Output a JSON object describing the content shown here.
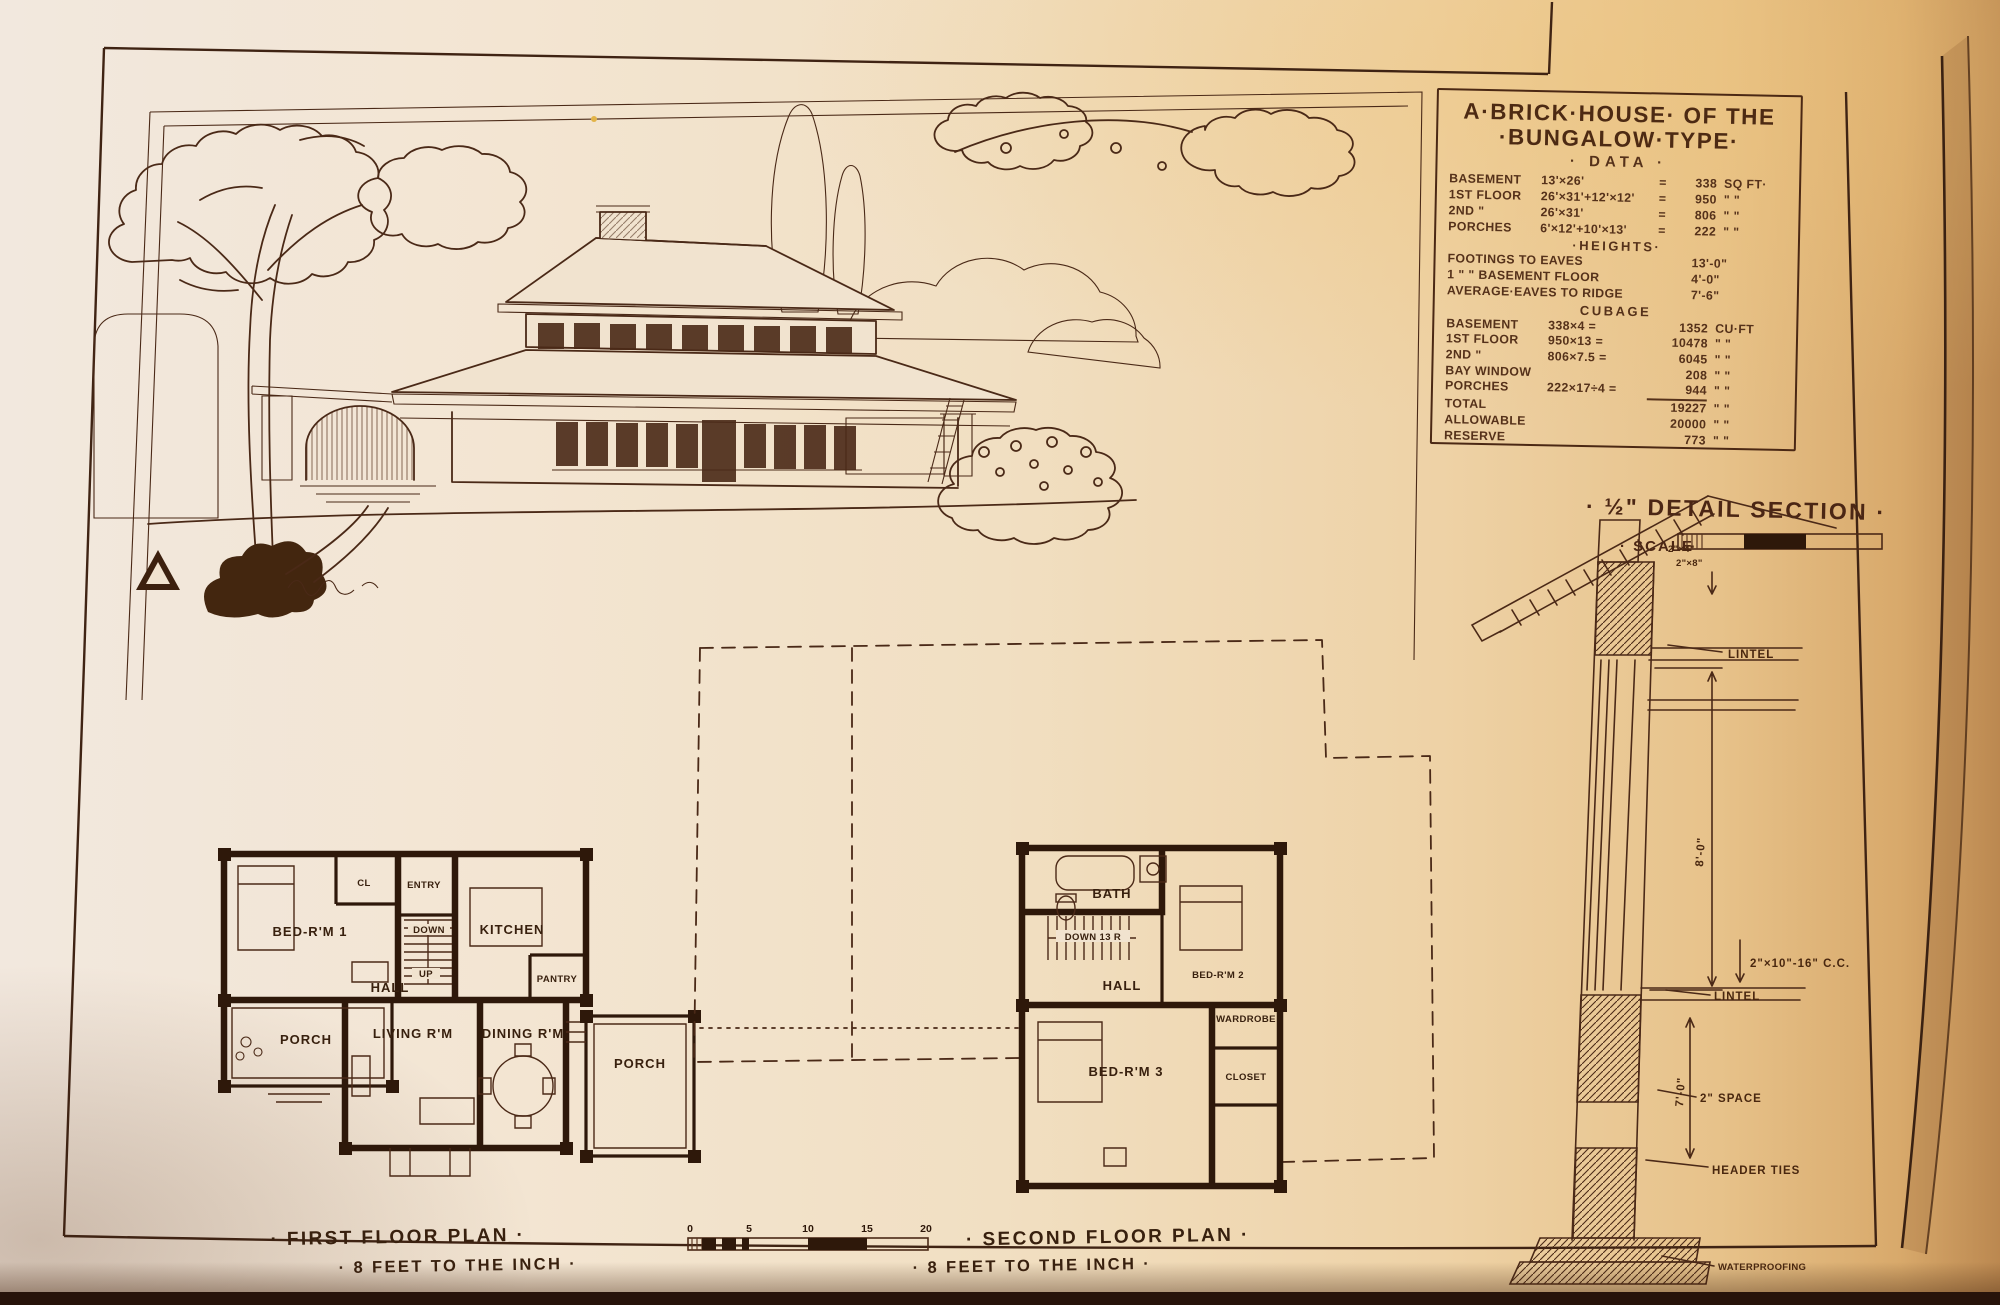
{
  "colors": {
    "ink": "#4b2917",
    "ink_dark": "#2e180a",
    "paper": "#f1e3cf"
  },
  "plate": {
    "data_panel": {
      "title_line1": "A·BRICK·HOUSE· OF THE",
      "title_line2": "·BUNGALOW·TYPE·",
      "subtitle": "· DATA ·",
      "area_rows": [
        {
          "label": "BASEMENT",
          "formula": "13'×26'",
          "eq": "=",
          "value": "338",
          "unit": "SQ FT·"
        },
        {
          "label": "1ST FLOOR",
          "formula": "26'×31'+12'×12'",
          "eq": "=",
          "value": "950",
          "unit": "\"  \""
        },
        {
          "label": "2ND  \"",
          "formula": "26'×31'",
          "eq": "=",
          "value": "806",
          "unit": "\"  \""
        },
        {
          "label": "PORCHES",
          "formula": "6'×12'+10'×13'",
          "eq": "=",
          "value": "222",
          "unit": "\"  \""
        }
      ],
      "heights_heading": "·HEIGHTS·",
      "height_rows": [
        {
          "label": "FOOTINGS TO EAVES",
          "value": "13'-0\""
        },
        {
          "label": "1  \"    \" BASEMENT FLOOR",
          "value": "4'-0\""
        },
        {
          "label": "AVERAGE·EAVES TO RIDGE",
          "value": "7'-6\""
        }
      ],
      "cubage_heading": "CUBAGE",
      "cubage_rows": [
        {
          "label": "BASEMENT",
          "formula": "338×4 =",
          "value": "1352",
          "unit": "CU·FT"
        },
        {
          "label": "1ST FLOOR",
          "formula": "950×13 =",
          "value": "10478",
          "unit": "\"  \""
        },
        {
          "label": "2ND  \"",
          "formula": "806×7.5 =",
          "value": "6045",
          "unit": "\"  \""
        },
        {
          "label": "BAY WINDOW",
          "formula": "",
          "value": "208",
          "unit": "\"  \""
        },
        {
          "label": "PORCHES",
          "formula": "222×17÷4 =",
          "value": "944",
          "unit": "\"  \""
        },
        {
          "label": "TOTAL",
          "formula": "",
          "value": "19227",
          "unit": "\"  \""
        },
        {
          "label": "ALLOWABLE",
          "formula": "",
          "value": "20000",
          "unit": "\"  \""
        },
        {
          "label": "RESERVE",
          "formula": "",
          "value": "773",
          "unit": "\"  \""
        }
      ]
    },
    "detail_section": {
      "title": "· ½\" DETAIL SECTION ·",
      "scale_label": "· SCALE",
      "labels": {
        "rafter_a": "2\"×4\"",
        "rafter_b": "2\"×8\"",
        "lintel_upper": "LINTEL",
        "dim_upper": "8'-0\"",
        "joists": "2\"×10\"-16\" C.C.",
        "lintel_lower": "LINTEL",
        "space": "2\" SPACE",
        "dim_lower": "7'-0\"",
        "header_ties": "HEADER TIES",
        "waterproofing": "WATERPROOFING"
      }
    },
    "first_floor": {
      "caption_line1": "· FIRST FLOOR PLAN ·",
      "caption_line2": "· 8 FEET TO THE INCH ·",
      "rooms": {
        "bedroom1": "BED-R'M 1",
        "closet": "CL",
        "entry": "ENTRY",
        "kitchen": "KITCHEN",
        "pantry": "PANTRY",
        "hall": "HALL",
        "living": "LIVING R'M",
        "dining": "DINING R'M",
        "porch_left": "PORCH",
        "porch_right": "PORCH",
        "stair_up": "UP",
        "stair_down": "DOWN"
      }
    },
    "second_floor": {
      "caption_line1": "· SECOND FLOOR PLAN ·",
      "caption_line2": "· 8 FEET TO THE INCH ·",
      "rooms": {
        "bath": "BATH",
        "hall": "HALL",
        "bedroom2": "BED-R'M 2",
        "wardrobe": "WARDROBE",
        "bedroom3": "BED-R'M 3",
        "closet": "CLOSET",
        "stair_down": "DOWN 13 R"
      }
    },
    "scale_bar": {
      "ticks": [
        "0",
        "5",
        "10",
        "15",
        "20"
      ]
    }
  }
}
